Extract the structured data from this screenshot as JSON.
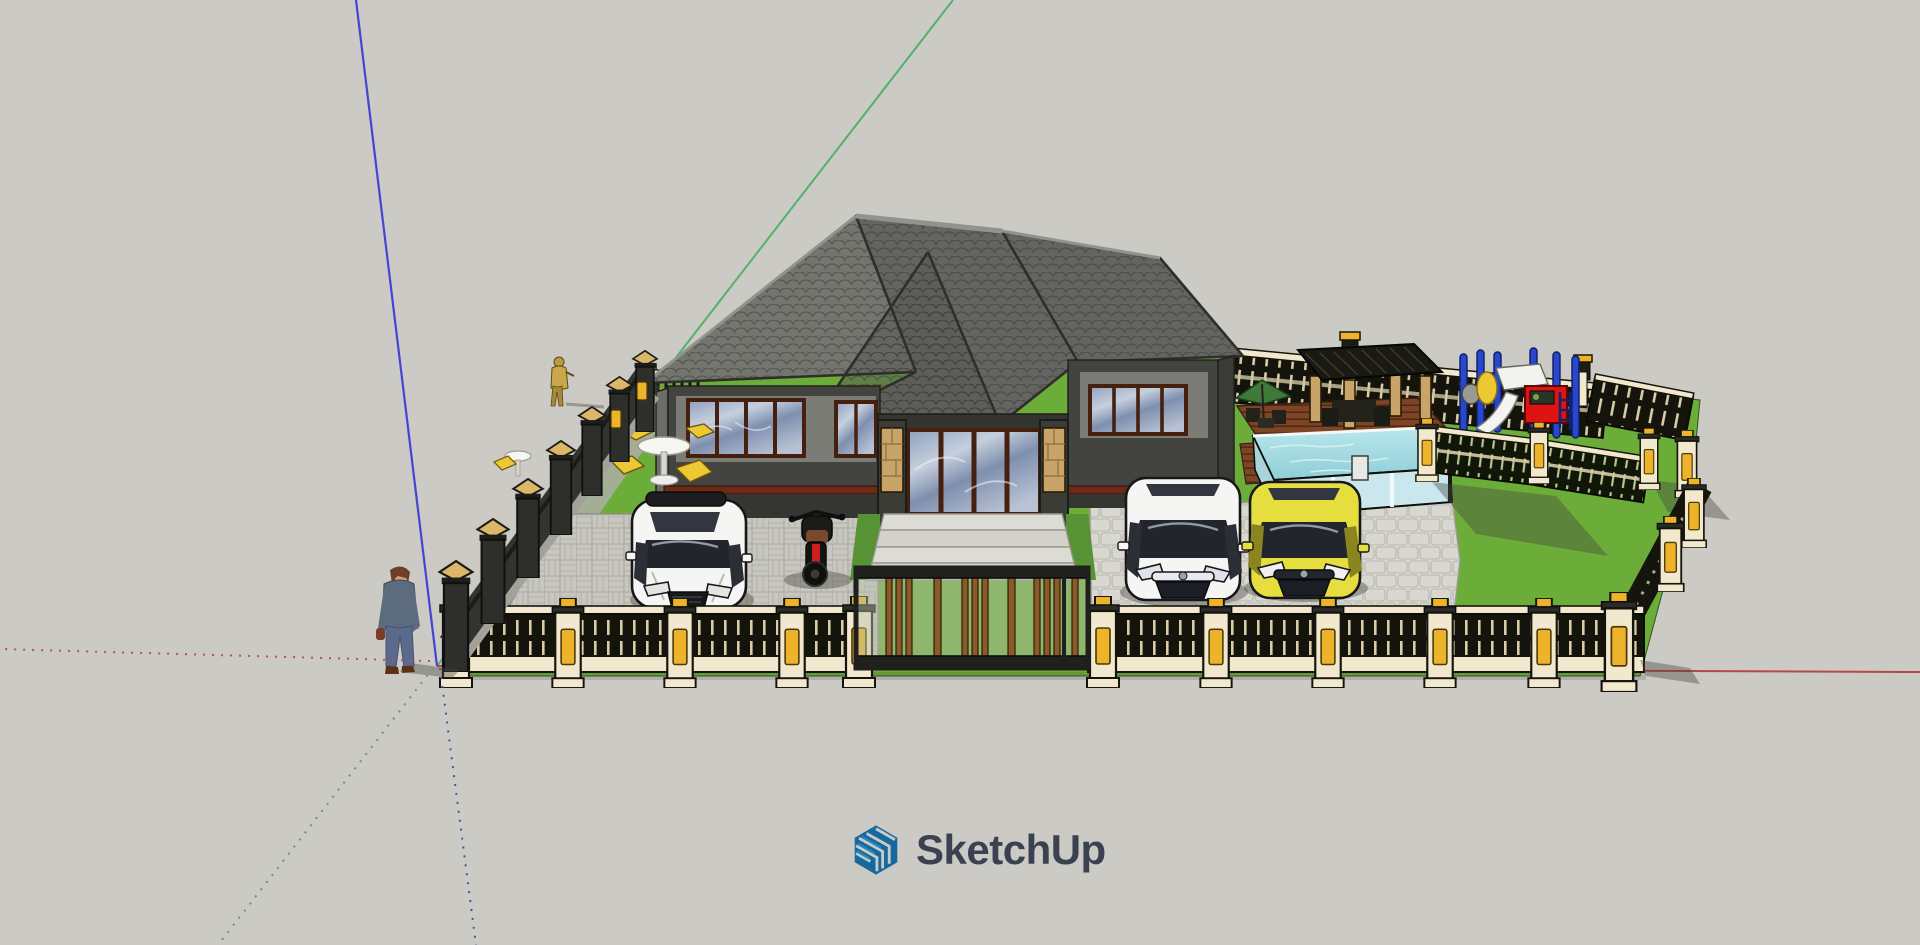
{
  "app": {
    "watermark": {
      "label": "SketchUp",
      "icon": "sketchup-logo"
    }
  },
  "viewport": {
    "width": 1920,
    "height": 945,
    "axes": {
      "origin_x": 437,
      "origin_y": 666
    }
  },
  "scene": {
    "model": "single-story hip-roof house with fenced yard, front gate, two driveways, swimming pool with wood deck and pergola, playground corner, patio table sets, white coupe, motorcycle, white sedan, yellow sedan, two human figures"
  },
  "theme": {
    "bg": "#cbcac5",
    "wm-text": "#3b4150",
    "wm-blue-dark": "#15699f",
    "wm-blue-mid": "#2b8ac2",
    "axis-blue": "#4545d2",
    "axis-green": "#53b16c",
    "axis-red": "#b64848",
    "axis-red-dot": "#c05050",
    "axis-green-dot": "#6a9a6a",
    "axis-blue-dot": "#5050a0",
    "roof-light": "#757570",
    "roof-mid": "#646460",
    "roof-dark": "#575753",
    "roof-line": "#2e2e2a",
    "ridge": "#93938d",
    "wall-dark": "#43433f",
    "wall-mid": "#6d6d68",
    "wall-light": "#7c7c76",
    "plinth": "#353532",
    "trim-maroon": "#6e2a16",
    "frame-brown": "#45200f",
    "stone-tan": "#c8a469",
    "step": "#dcdcd5",
    "lawn": "#6cad39",
    "lawn-dark": "#579234",
    "paver-left": "#c7c7c0",
    "paver-right": "#d8d8d0",
    "fence-cream": "#f2e8cd",
    "fence-gold": "#edb32a",
    "fence-dark": "#14140c",
    "pillar-dark": "#2e2e2b",
    "cap-tan": "#dcb76a",
    "pool-water": "#9fd6de",
    "pool-glass": "#c9e7ec",
    "deck": "#7d4526",
    "deck-line": "#4f2a14",
    "pergola-dark": "#1a1a12",
    "play-blue": "#2847cc",
    "play-red": "#e01313",
    "play-yellow": "#ecc832",
    "car-white": "#f5f5f3",
    "car-yellow": "#e6de3e",
    "car-window": "#23252c",
    "skin": "#c99f7e",
    "shirt": "#5c6b7e",
    "jeans": "#5a6a8c",
    "shadow": "rgba(70,70,62,0.40)"
  }
}
